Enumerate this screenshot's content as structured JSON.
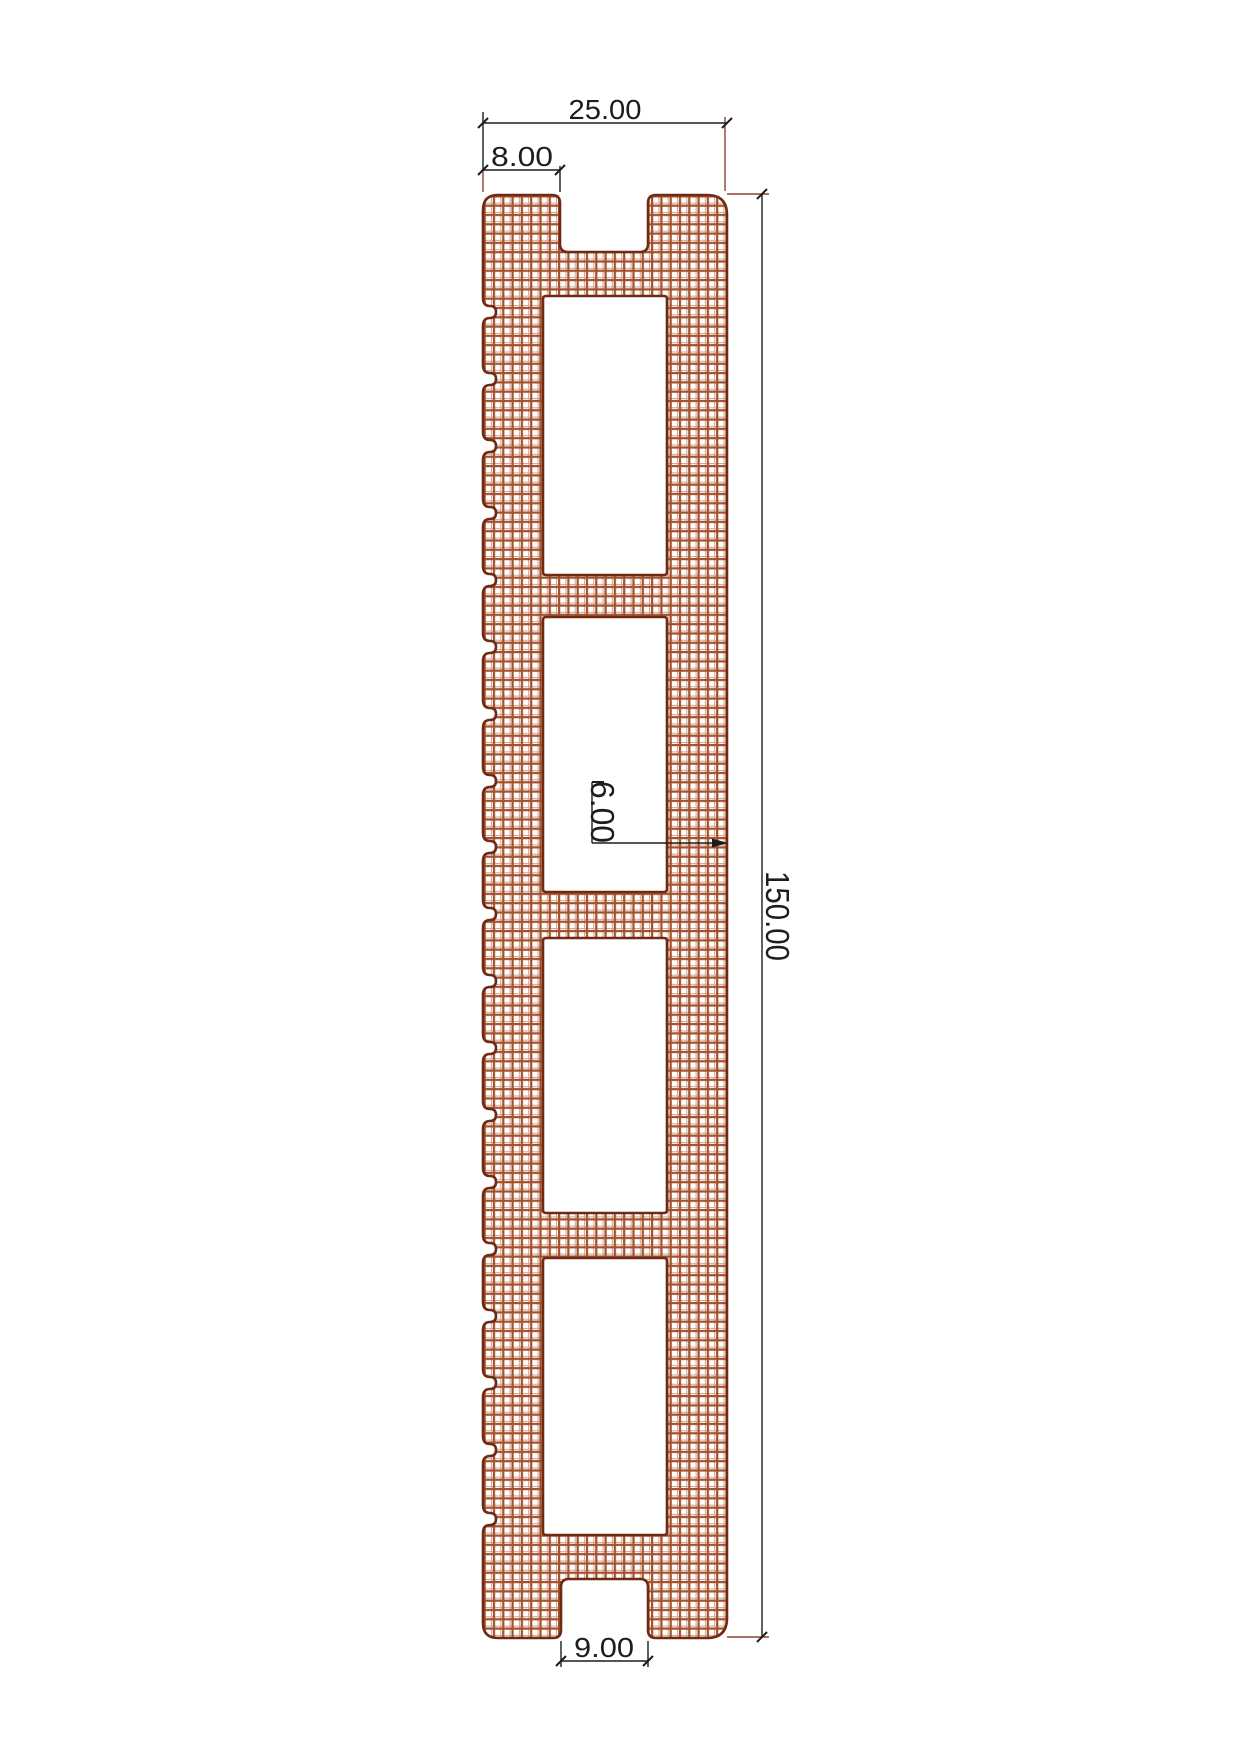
{
  "drawing": {
    "type": "cad-profile-cross-section",
    "dim_overall_width": "25.00",
    "dim_top_tab_width": "8.00",
    "dim_overall_length": "150.00",
    "dim_wall_thickness": "6.00",
    "dim_groove_width": "9.00"
  },
  "colors": {
    "outline": "#6f2a13",
    "hatch_main": "#a3512e",
    "hatch_light": "#d4a087",
    "dimension": "#1d1d1d",
    "extension": "#8a4530",
    "background": "#ffffff"
  }
}
